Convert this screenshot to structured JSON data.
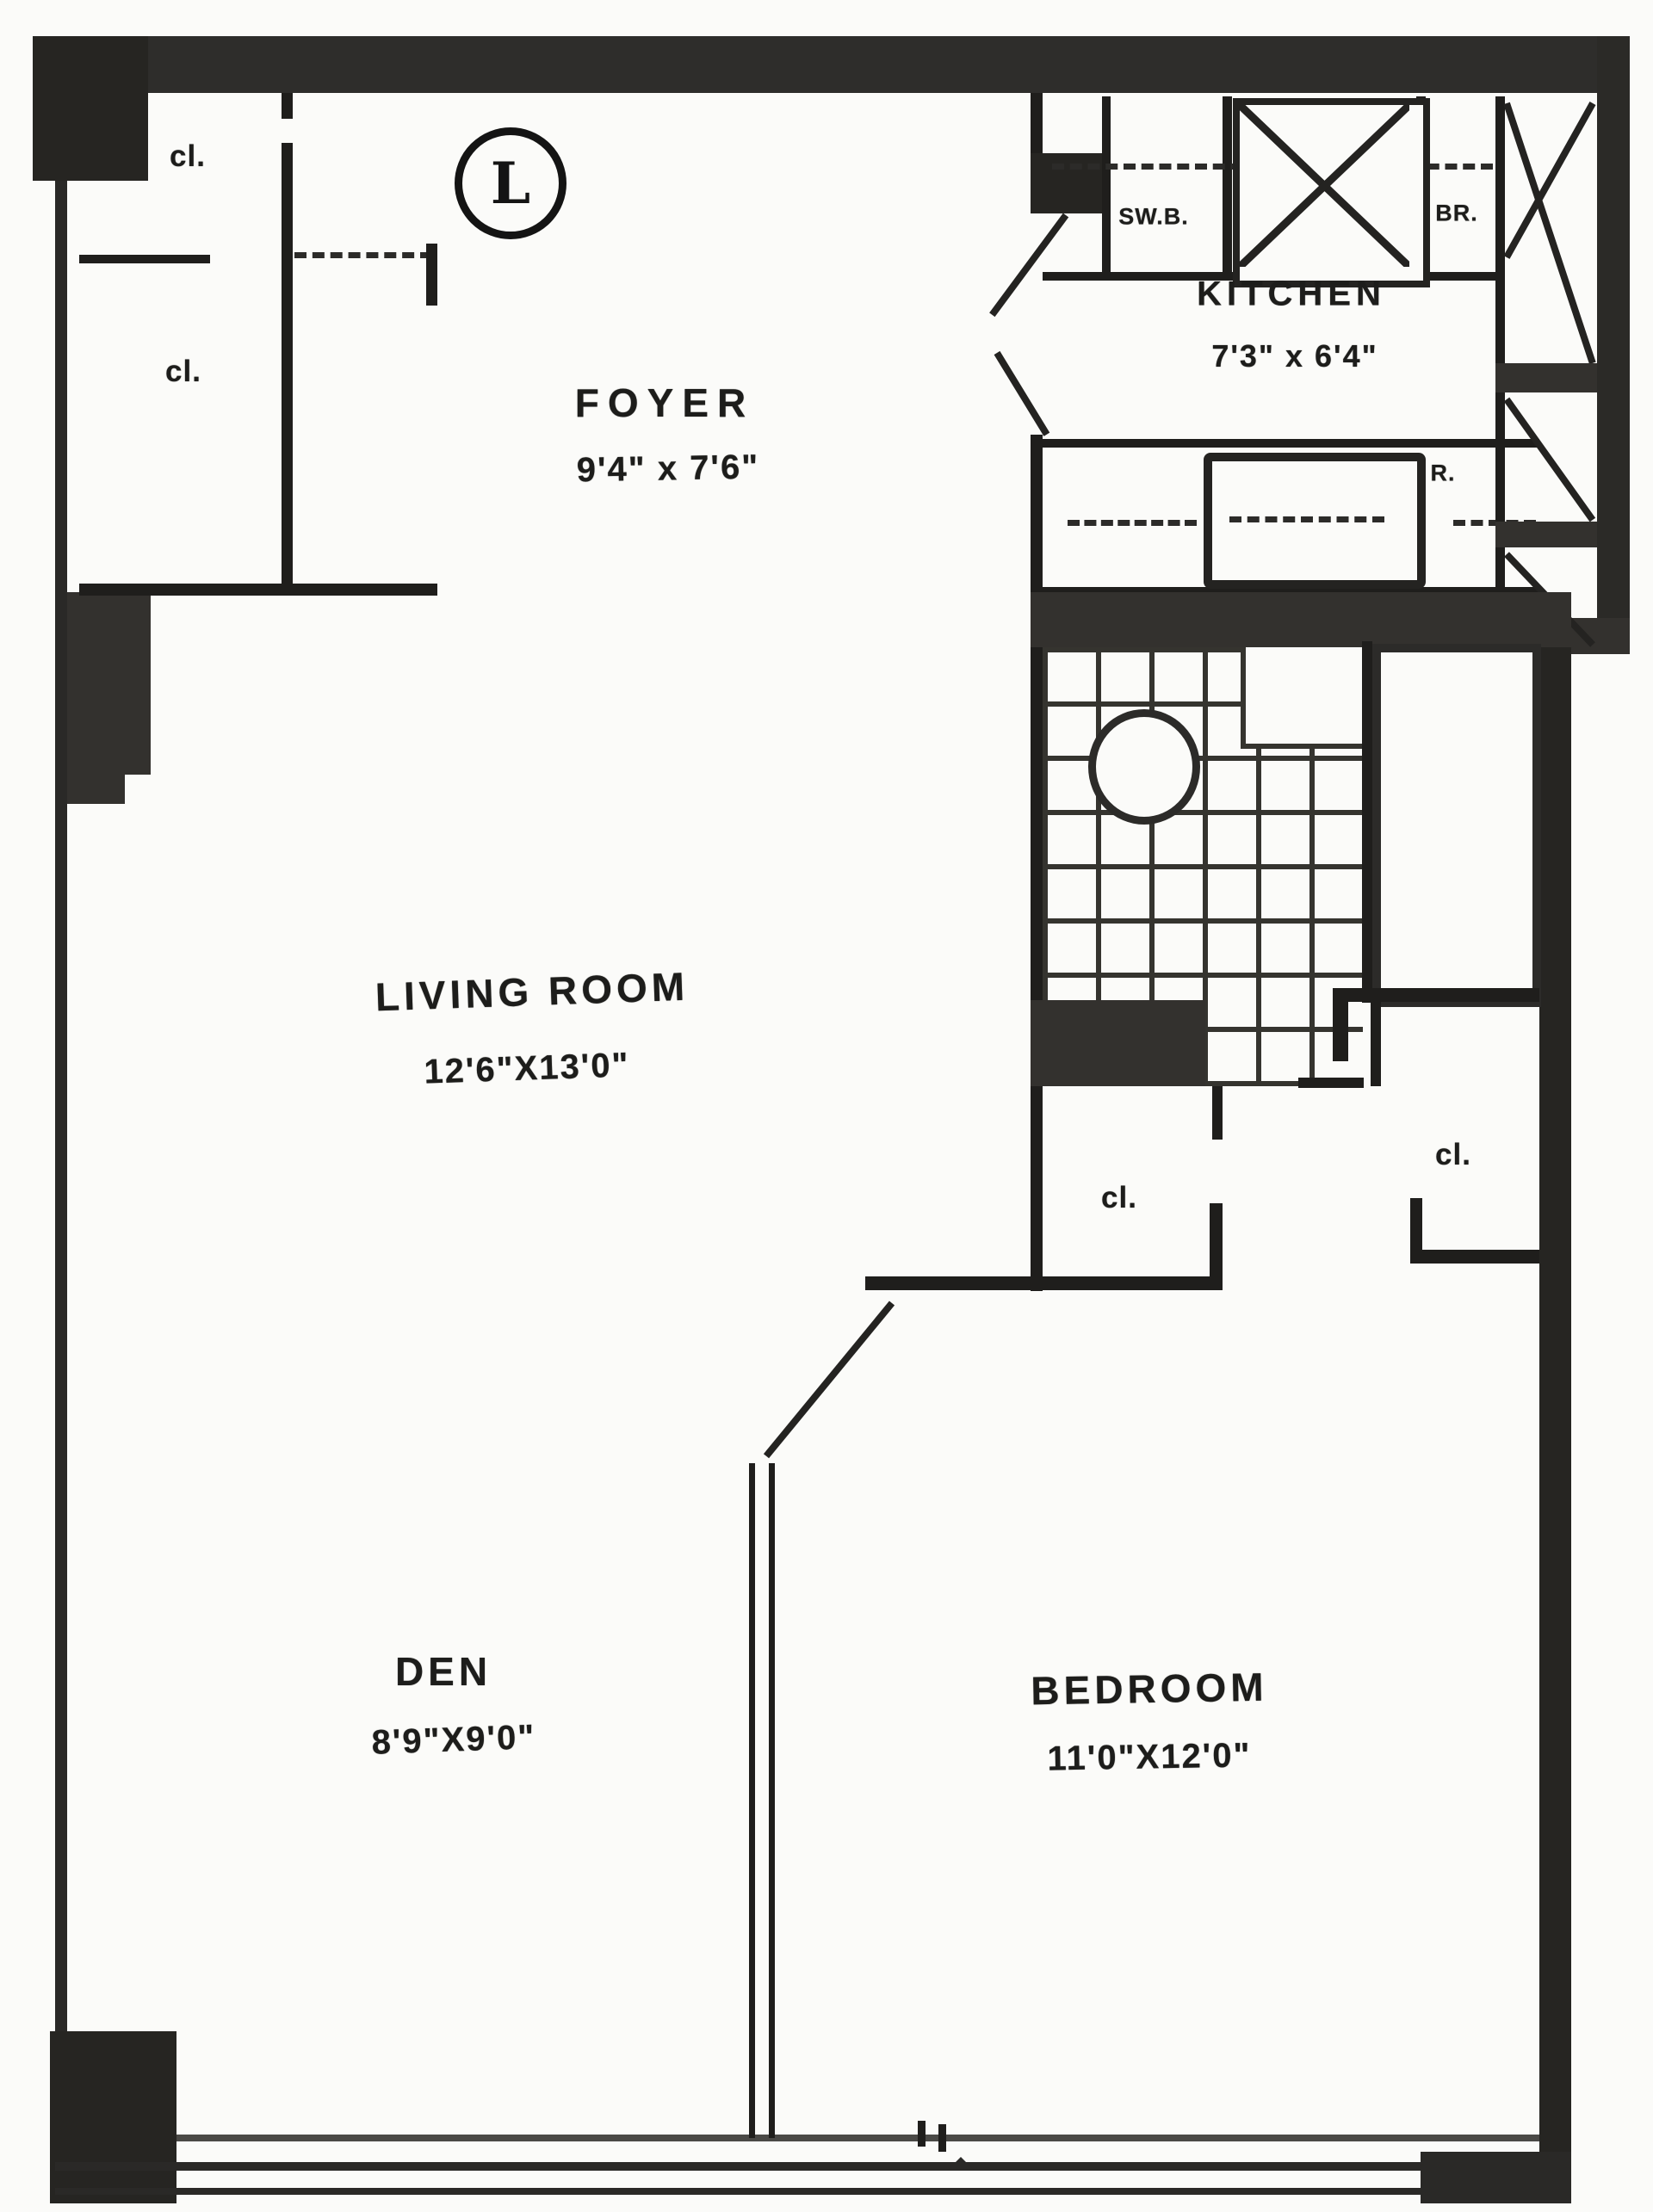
{
  "plan": {
    "unit_letter": "L",
    "rooms": {
      "foyer": {
        "name": "FOYER",
        "dims": "9'4\" x 7'6\""
      },
      "kitchen": {
        "name": "KITCHEN",
        "dims": "7'3\" x 6'4\""
      },
      "living_room": {
        "name": "LIVING ROOM",
        "dims": "12'6\"X13'0\""
      },
      "den": {
        "name": "DEN",
        "dims": "8'9\"X9'0\""
      },
      "bedroom": {
        "name": "BEDROOM",
        "dims": "11'0\"X12'0\""
      }
    },
    "closet_label": "cl.",
    "kitchen_labels": {
      "cabinet_left": "SW.B.",
      "cabinet_right": "BR.",
      "refrigerator": "R."
    },
    "colors": {
      "paper": "#fbfbf9",
      "wall": "#1f1e1c",
      "poche": "#33312e"
    }
  }
}
